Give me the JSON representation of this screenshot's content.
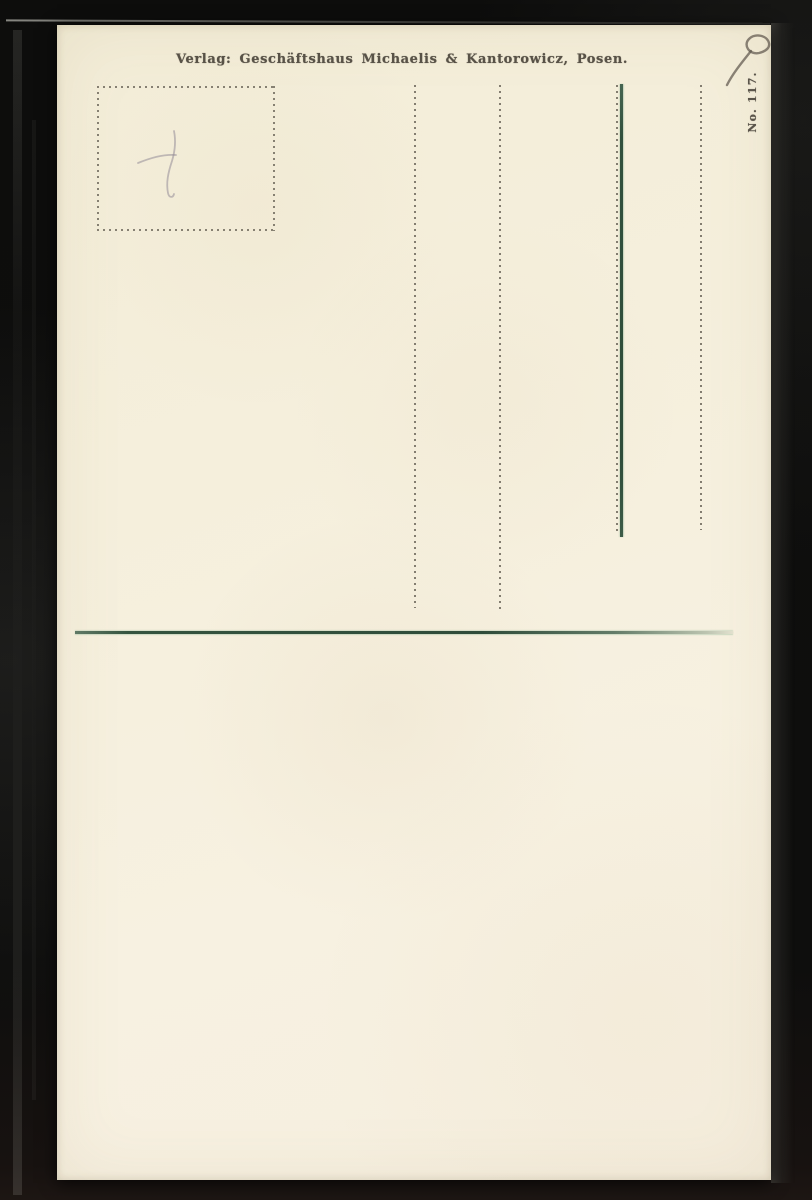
{
  "postcard": {
    "publisher_line": "Verlag: Geschäftshaus Michaelis & Kantorowicz, Posen.",
    "card_number": "No. 117."
  },
  "colors": {
    "paper": "#f5efdc",
    "print_ink": "#585247",
    "dotted_rule": "#6f695d",
    "green_rule": "#315040",
    "backdrop": "#0d0d0c"
  }
}
